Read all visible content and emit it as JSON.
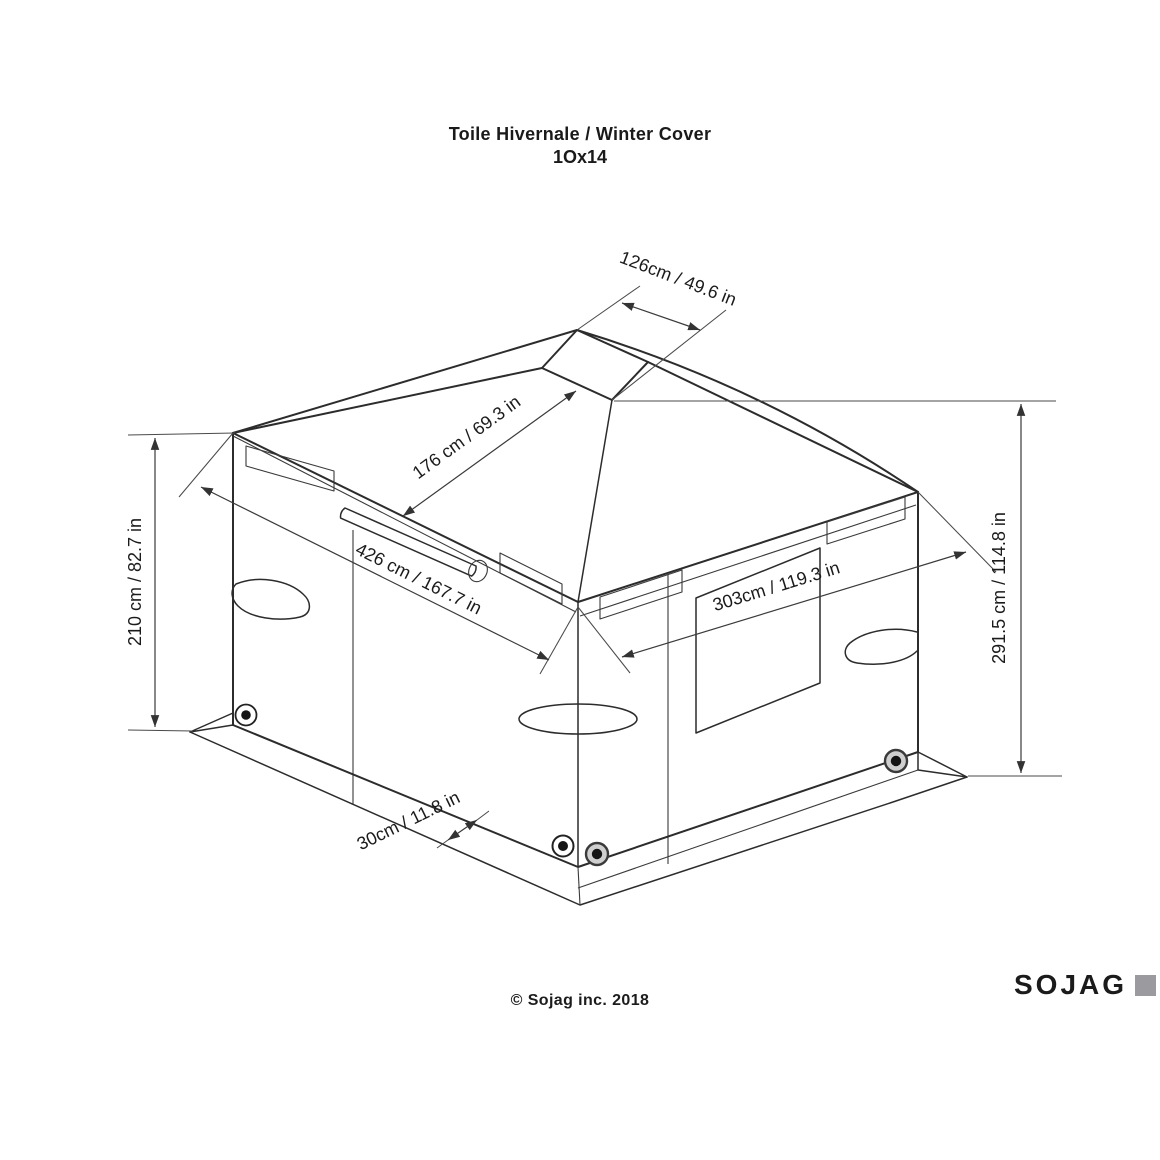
{
  "title": {
    "line1": "Toile Hivernale / Winter Cover",
    "line2": "1Ox14"
  },
  "dimensions": {
    "top_opening": "126cm / 49.6 in",
    "roof_slope": "176 cm / 69.3 in",
    "front_width": "426 cm / 167.7 in",
    "side_width": "303cm / 119.3 in",
    "wall_height": "210 cm / 82.7 in",
    "total_height": "291.5 cm / 114.8 in",
    "skirt_depth": "30cm / 11.8 in"
  },
  "footer": {
    "copyright": "© Sojag inc. 2018"
  },
  "brand": {
    "name": "SOJAG"
  },
  "colors": {
    "line": "#2c2c2c",
    "dimension": "#3a3a3a",
    "text": "#1b1b1b",
    "brand_square": "#9b9b9f"
  }
}
